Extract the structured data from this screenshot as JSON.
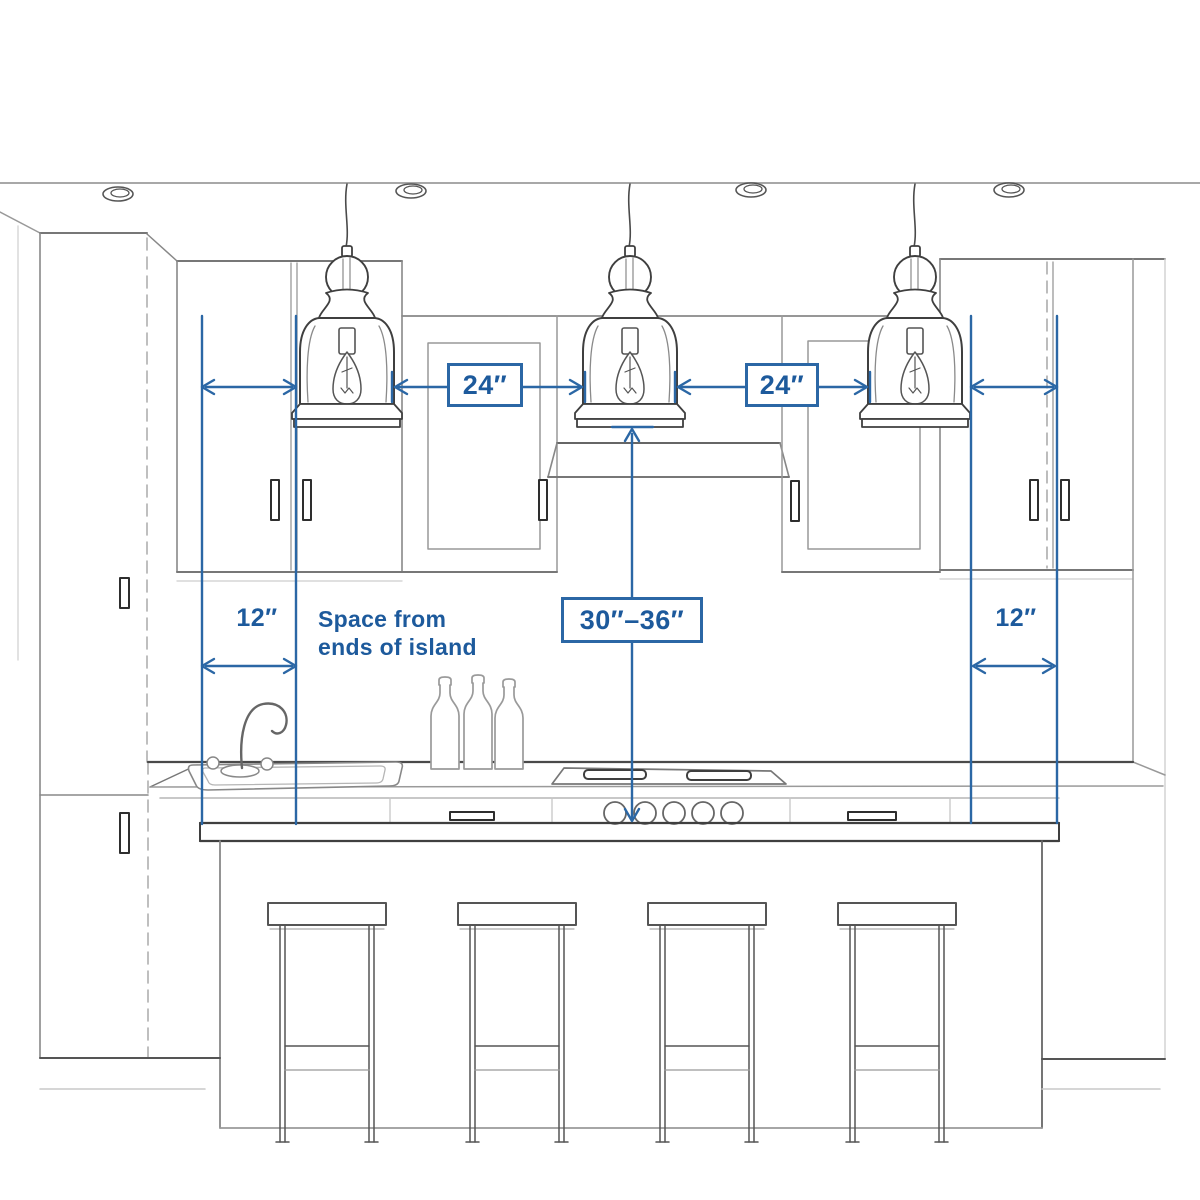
{
  "diagram": {
    "colors": {
      "accent_line": "#2b67a5",
      "accent_text": "#1d5a9c",
      "sketch": "#555555",
      "background": "#ffffff"
    },
    "dimensions": {
      "pendant_gap_left": "24″",
      "pendant_gap_right": "24″",
      "island_end_left": "12″",
      "island_end_right": "12″",
      "height_above_island": "30″–36″"
    },
    "annotations": {
      "island_end_note_line1": "Space from",
      "island_end_note_line2": "ends of island"
    }
  }
}
